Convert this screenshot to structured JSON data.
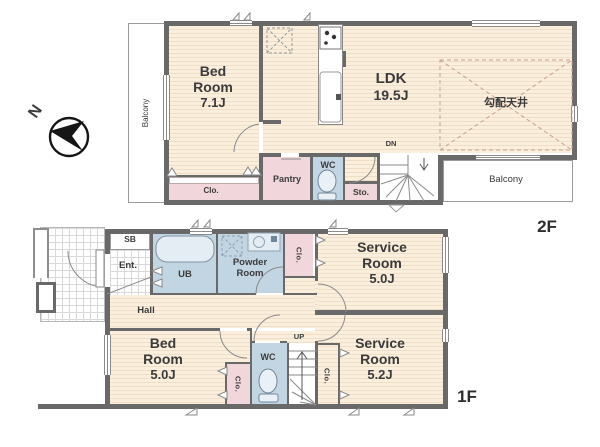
{
  "compass": {
    "north": "N"
  },
  "floor2": {
    "label": "2F",
    "balcony_west": "Balcony",
    "balcony_south": "Balcony",
    "bedroom": {
      "name": "Bed Room",
      "size": "7.1J"
    },
    "bedroom_closet": "Clo.",
    "ldk": {
      "name": "LDK",
      "size": "19.5J"
    },
    "sloped_ceiling_note": "勾配天井",
    "pantry": "Pantry",
    "wc": "WC",
    "storage": "Sto.",
    "stairs_direction": "DN"
  },
  "floor1": {
    "label": "1F",
    "shoe_box": "SB",
    "entrance": "Ent.",
    "hall": "Hall",
    "unit_bath": "UB",
    "powder_room": "Powder Room",
    "service_room_a_closet": "Clo.",
    "bedroom": {
      "name": "Bed Room",
      "size": "5.0J"
    },
    "bedroom_closet": "Clo.",
    "wc": "WC",
    "stairs_direction": "UP",
    "service_room_b_closet": "Clo.",
    "service_room_a": {
      "name": "Service Room",
      "size": "5.0J"
    },
    "service_room_b": {
      "name": "Service Room",
      "size": "5.2J"
    }
  },
  "colors": {
    "wall": "#696969",
    "wood_floor": "#faeedd",
    "closet_pink": "#f1d6db",
    "wet_area_blue": "#c2d5e2",
    "sloped_ceiling_dash": "#c6a28e"
  }
}
